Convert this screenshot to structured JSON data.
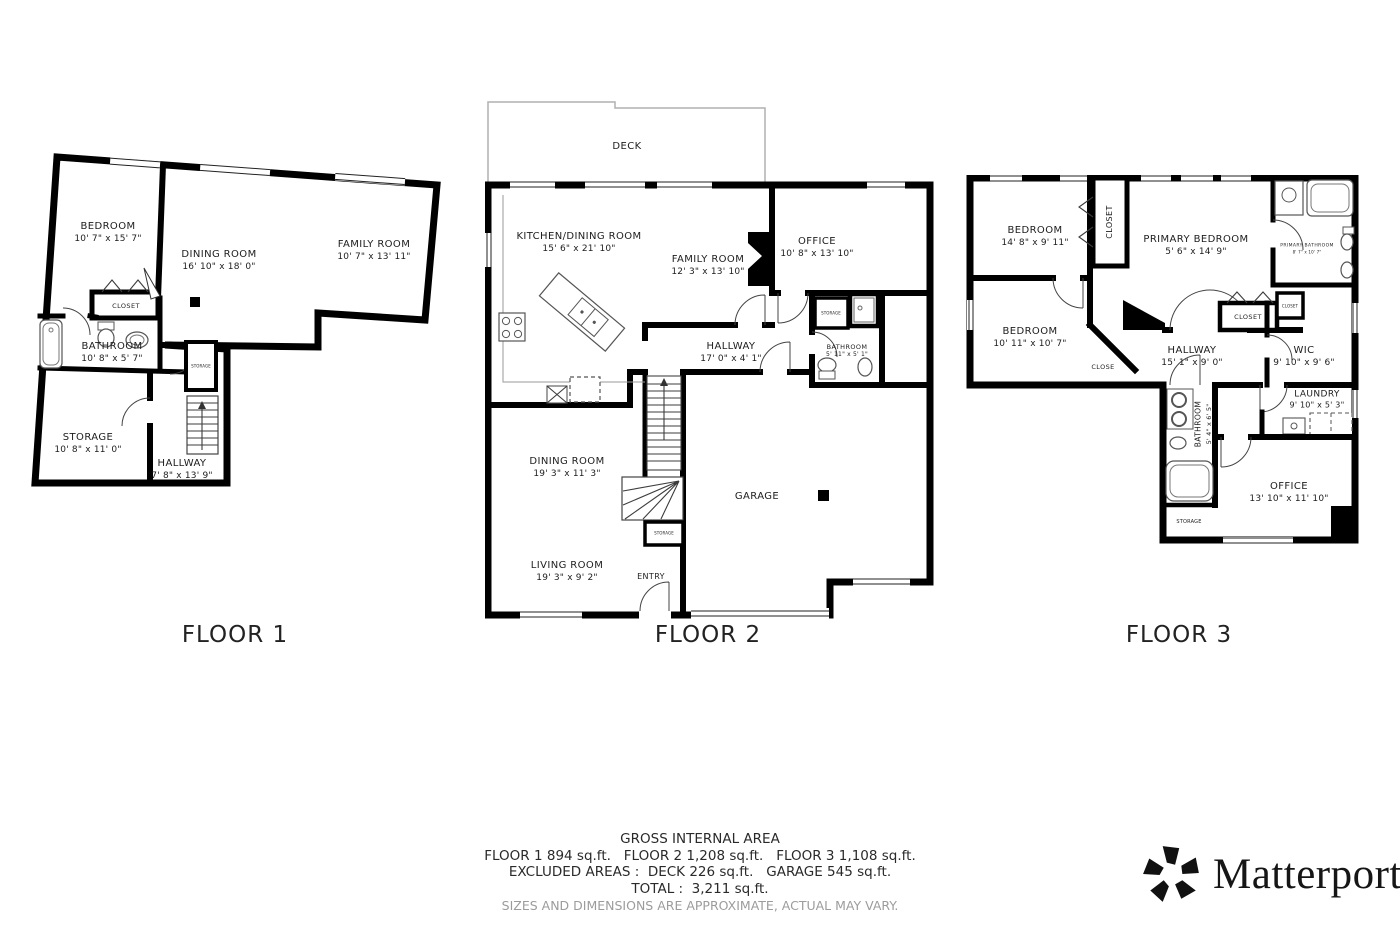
{
  "floors": [
    {
      "title": "FLOOR 1",
      "rooms": [
        {
          "name": "BEDROOM",
          "dims": "10' 7\" x 15' 7\""
        },
        {
          "name": "DINING ROOM",
          "dims": "16' 10\" x 18' 0\""
        },
        {
          "name": "FAMILY ROOM",
          "dims": "10' 7\" x 13' 11\""
        },
        {
          "name": "CLOSET",
          "dims": ""
        },
        {
          "name": "BATHROOM",
          "dims": "10' 8\" x 5' 7\""
        },
        {
          "name": "STORAGE",
          "dims": "10' 8\" x 11' 0\""
        },
        {
          "name": "HALLWAY",
          "dims": "7' 8\" x 13' 9\""
        },
        {
          "name": "STORAGE",
          "dims": ""
        }
      ]
    },
    {
      "title": "FLOOR 2",
      "rooms": [
        {
          "name": "DECK",
          "dims": ""
        },
        {
          "name": "KITCHEN/DINING ROOM",
          "dims": "15' 6\" x 21' 10\""
        },
        {
          "name": "FAMILY ROOM",
          "dims": "12' 3\" x 13' 10\""
        },
        {
          "name": "OFFICE",
          "dims": "10' 8\" x 13' 10\""
        },
        {
          "name": "STORAGE",
          "dims": ""
        },
        {
          "name": "BATHROOM",
          "dims": "5' 11\" x 5' 1\""
        },
        {
          "name": "HALLWAY",
          "dims": "17' 0\" x 4' 1\""
        },
        {
          "name": "DINING ROOM",
          "dims": "19' 3\" x 11' 3\""
        },
        {
          "name": "GARAGE",
          "dims": ""
        },
        {
          "name": "STORAGE",
          "dims": ""
        },
        {
          "name": "LIVING ROOM",
          "dims": "19' 3\" x 9' 2\""
        },
        {
          "name": "ENTRY",
          "dims": ""
        }
      ]
    },
    {
      "title": "FLOOR 3",
      "rooms": [
        {
          "name": "BEDROOM",
          "dims": "14' 8\" x 9' 11\""
        },
        {
          "name": "CLOSET",
          "dims": ""
        },
        {
          "name": "PRIMARY BEDROOM",
          "dims": "5' 6\" x 14' 9\""
        },
        {
          "name": "PRIMARY BATHROOM",
          "dims": "8' 7\" x 10' 7\""
        },
        {
          "name": "CLOSET",
          "dims": ""
        },
        {
          "name": "CLOSET",
          "dims": ""
        },
        {
          "name": "BEDROOM",
          "dims": "10' 11\" x 10' 7\""
        },
        {
          "name": "CLOSE",
          "dims": ""
        },
        {
          "name": "HALLWAY",
          "dims": "15' 1\" x 9' 0\""
        },
        {
          "name": "WIC",
          "dims": "9' 10\" x 9' 6\""
        },
        {
          "name": "LAUNDRY",
          "dims": "9' 10\" x 5' 3\""
        },
        {
          "name": "BATHROOM",
          "dims": "5' 4\" x 6' 5\""
        },
        {
          "name": "STORAGE",
          "dims": ""
        },
        {
          "name": "OFFICE",
          "dims": "13' 10\" x 11' 10\""
        }
      ]
    }
  ],
  "footer": {
    "heading": "GROSS INTERNAL AREA",
    "floors_line": "FLOOR 1 894 sq.ft.   FLOOR 2 1,208 sq.ft.   FLOOR 3 1,108 sq.ft.",
    "excluded_line": "EXCLUDED AREAS :  DECK 226 sq.ft.   GARAGE 545 sq.ft.",
    "total_line": "TOTAL :  3,211 sq.ft.",
    "disclaimer": "SIZES AND DIMENSIONS ARE APPROXIMATE, ACTUAL MAY VARY."
  },
  "brand": {
    "name": "Matterport",
    "registered": "®",
    "icon": "matterport-pinwheel-icon"
  },
  "colors": {
    "wall": "#000000",
    "deck_outline": "#b0b0b0",
    "disclaimer_text": "#9c9c9c"
  }
}
